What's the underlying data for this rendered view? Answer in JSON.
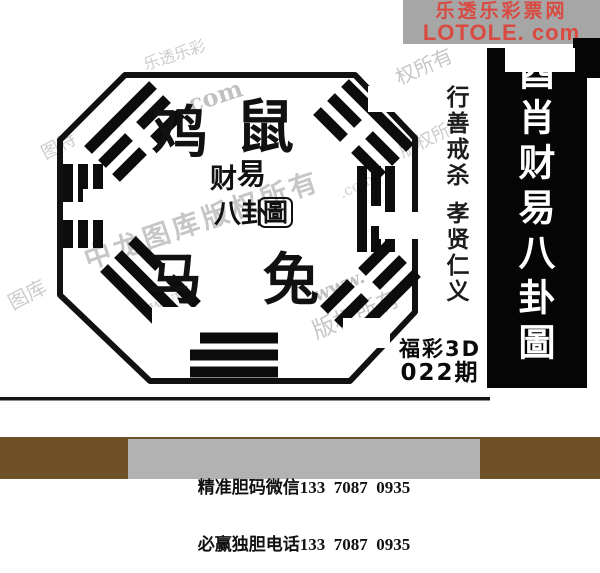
{
  "logo": {
    "line1": "乐透乐彩票网",
    "line2": "LOTOLE. com",
    "bg_color": "#a6a6a6",
    "text_color": "#d94a41"
  },
  "side_panel": {
    "first_char": "酉",
    "title_rest": "肖财易八卦圖",
    "bg_color": "#050505",
    "text_color": "#ffffff"
  },
  "virtue_column": {
    "top": "行善戒杀",
    "bottom": "孝贤仁义"
  },
  "bagua": {
    "zodiac_top_left": "鸡",
    "zodiac_top_right": "鼠",
    "zodiac_bottom_left": "马",
    "zodiac_bottom_right": "兔",
    "center_char_1": "财",
    "center_char_2": "易",
    "center_char_3": "八卦",
    "center_seal": "圖"
  },
  "lottery": {
    "name": "福彩3D",
    "issue": "022期"
  },
  "contact_bar": {
    "line1": "精准胆码微信133  7087  0935",
    "line2": "必赢独胆电话133  7087  0935",
    "bar_color": "#6f5128",
    "box_color": "#b2b2b2"
  },
  "watermarks": [
    "乐透乐彩",
    ". com",
    "权所有",
    "版权所有",
    ".com",
    "中龙图库版权所有",
    "www.",
    "版权所有",
    "图特",
    "图库",
    "www."
  ]
}
